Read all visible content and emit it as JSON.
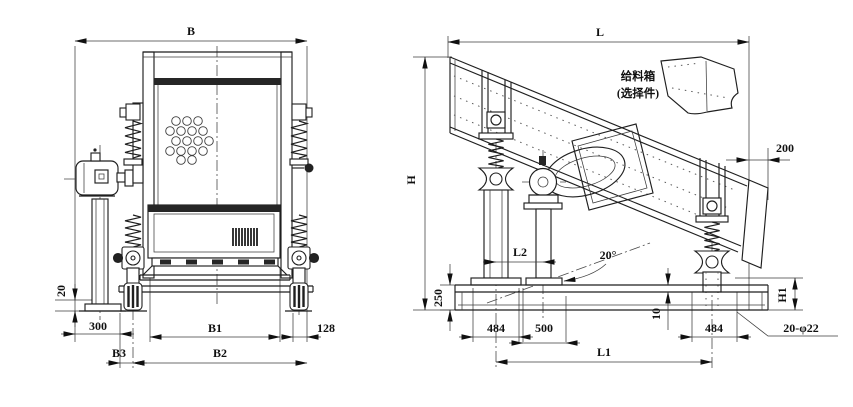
{
  "colors": {
    "background": "#ffffff",
    "line": "#1f1f1f",
    "text": "#101010"
  },
  "front_view": {
    "dims": {
      "b": "B",
      "h20": "20",
      "w300": "300",
      "b1": "B1",
      "w128": "128",
      "b3": "B3",
      "b2": "B2"
    }
  },
  "side_view": {
    "feed_box_note": {
      "line1": "给料箱",
      "line2": "(选择件)"
    },
    "dims": {
      "l": "L",
      "h": "H",
      "w200": "200",
      "l2": "L2",
      "angle": "20°",
      "h250": "250",
      "w484_left": "484",
      "w500": "500",
      "h10": "10",
      "w484_right": "484",
      "h1": "H1",
      "bolt_holes": "20-φ22",
      "l1": "L1"
    }
  }
}
